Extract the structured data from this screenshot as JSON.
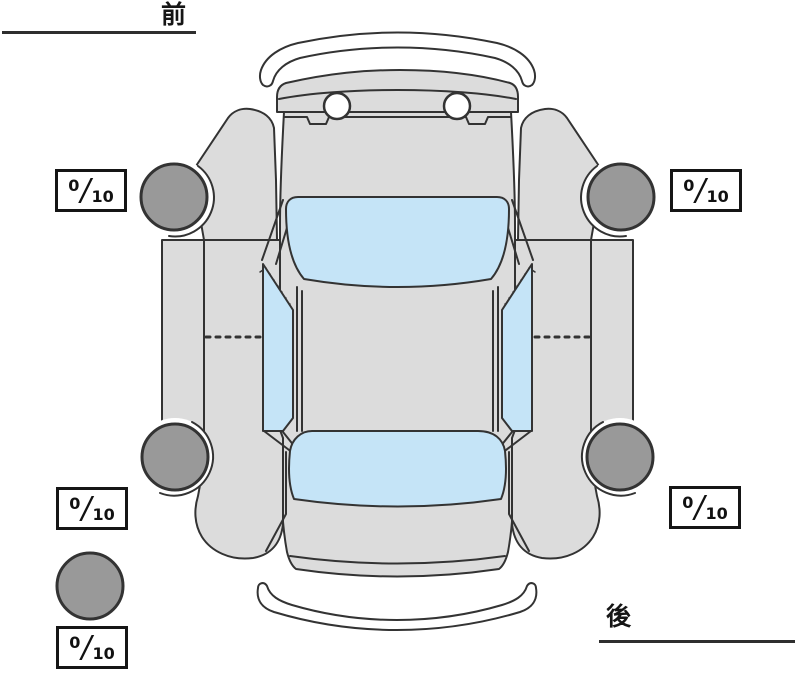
{
  "labels": {
    "front": "前",
    "rear": "後"
  },
  "tread_scores": {
    "front_left": {
      "value": "0",
      "separator": "/",
      "max": "10"
    },
    "front_right": {
      "value": "0",
      "separator": "/",
      "max": "10"
    },
    "rear_left": {
      "value": "0",
      "separator": "/",
      "max": "10"
    },
    "rear_right": {
      "value": "0",
      "separator": "/",
      "max": "10"
    },
    "spare": {
      "value": "0",
      "separator": "/",
      "max": "10"
    }
  },
  "diagram": {
    "type": "car-top-view",
    "wheels": [
      "front-left",
      "front-right",
      "rear-left",
      "rear-right",
      "spare"
    ],
    "colors": {
      "body": "#dcdcdc",
      "glass": "#c5e4f7",
      "tire": "#999999",
      "outline": "#333333",
      "bumper_fill": "#ffffff"
    }
  }
}
